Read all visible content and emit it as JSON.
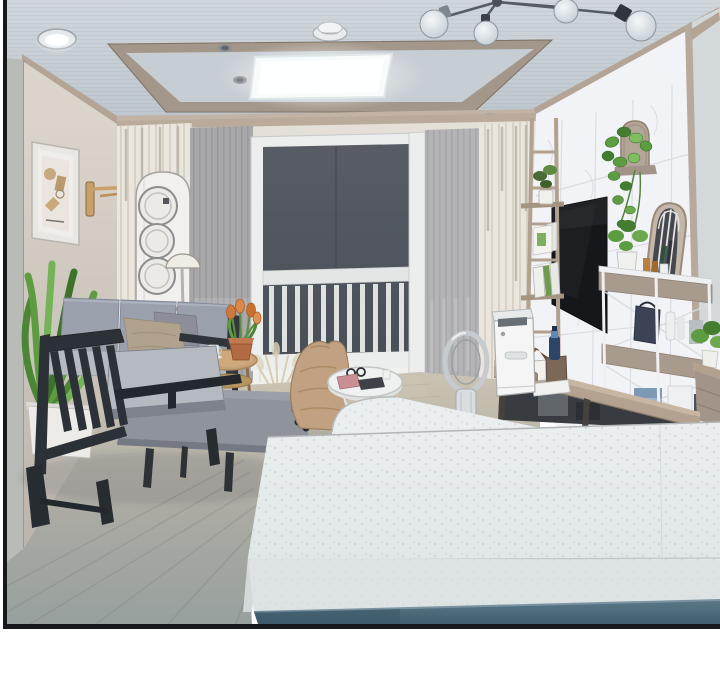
{
  "meta": {
    "kind": "illustration",
    "setting": "apartment living room interior at night, webtoon panel style",
    "panel": {
      "border_color": "#17181b",
      "gutter_color": "#ffffff"
    }
  },
  "scene": {
    "objects": [
      "tray ceiling with flat LED panel light",
      "recessed ceiling downlight",
      "smoke detector",
      "sputnik branch chandelier with glass bulbs",
      "framed abstract wall art",
      "brass swing-arm wall lamp",
      "white tower speaker with three round drivers",
      "white dome floor lamp",
      "cream striped curtains and gray sheer curtains",
      "large dark window with white frame",
      "white balcony railing seen through window",
      "white marble tiled accent wall",
      "wall-mounted black TV",
      "wooden ladder shelf with plants, frames and books",
      "arched mirror leaning on wall",
      "white metal shelving rack with taupe bins, bags and towels",
      "hanging pothos plant on arched wall shelf",
      "white air purifier",
      "bladeless ring fan",
      "wooden desk with house-shaped lamp, box, blue bottle and book",
      "gray fabric sofa with beige and gray pillows",
      "dark wood slat-back armchair",
      "gray chaise ottoman",
      "round wooden side table with tulip pot and coffee cups",
      "dried pampas grass in vase",
      "office chair with tan jacket draped over it",
      "open laptop",
      "round white coffee table with sunglasses, pink pouch and tablet",
      "potted plants",
      "speckled white kitchen island with blue-gray cabinet base",
      "gray wood plank floor"
    ]
  },
  "palette": {
    "panel_border": "#17181b",
    "gutter": "#ffffff",
    "ceiling_top": "#d0d7dc",
    "ceiling_bottom": "#bcc5cc",
    "tray_wood": "#a3968a",
    "tray_recess": "#c6cdd3",
    "led_panel": "#f7fbfc",
    "crown": "#b3a496",
    "wall_side_strip": "#b9bcb6",
    "window_wall": "#e4dfd7",
    "curtain_cream": "#eae6dd",
    "sheer_gray": "#a8a8ab",
    "sheer_gray_light": "#b4b4b6",
    "window_frame": "#eceeed",
    "glass_dark": "#53585f",
    "railing_white": "#e3e6e5",
    "marble": "#f2f3f6",
    "tv_black": "#15171b",
    "ladder_wood": "#b2a18f",
    "rack_band": "#a89a8c",
    "mirror_frame": "#c4b7a9",
    "desk_wood": "#b3a290",
    "purifier_white": "#f4f5f4",
    "fan_silver": "#c6cbcf",
    "sofa_gray": "#9ba1ac",
    "seat_gray": "#b5b9c0",
    "chaise_gray": "#8e939c",
    "frame_dark": "#2c3137",
    "pillow_beige": "#b1a28d",
    "pillow_gray": "#8c8e99",
    "jacket_tan": "#c2a182",
    "plant_green": "#5e9c41",
    "plant_green_dark": "#447c30",
    "tulip_orange": "#cf7a3c",
    "terracotta": "#b26b42",
    "table_wood": "#c4a178",
    "floor_warm": "#c7bfae",
    "floor_cool": "#98a09d",
    "island_top": "#e8ecec",
    "island_front": "#dde3e3",
    "island_side": "#d3d9d9",
    "cabinet_blue": "#4e6b7d",
    "lamp_brass": "#c9a06a",
    "dome_white": "#efece6"
  }
}
